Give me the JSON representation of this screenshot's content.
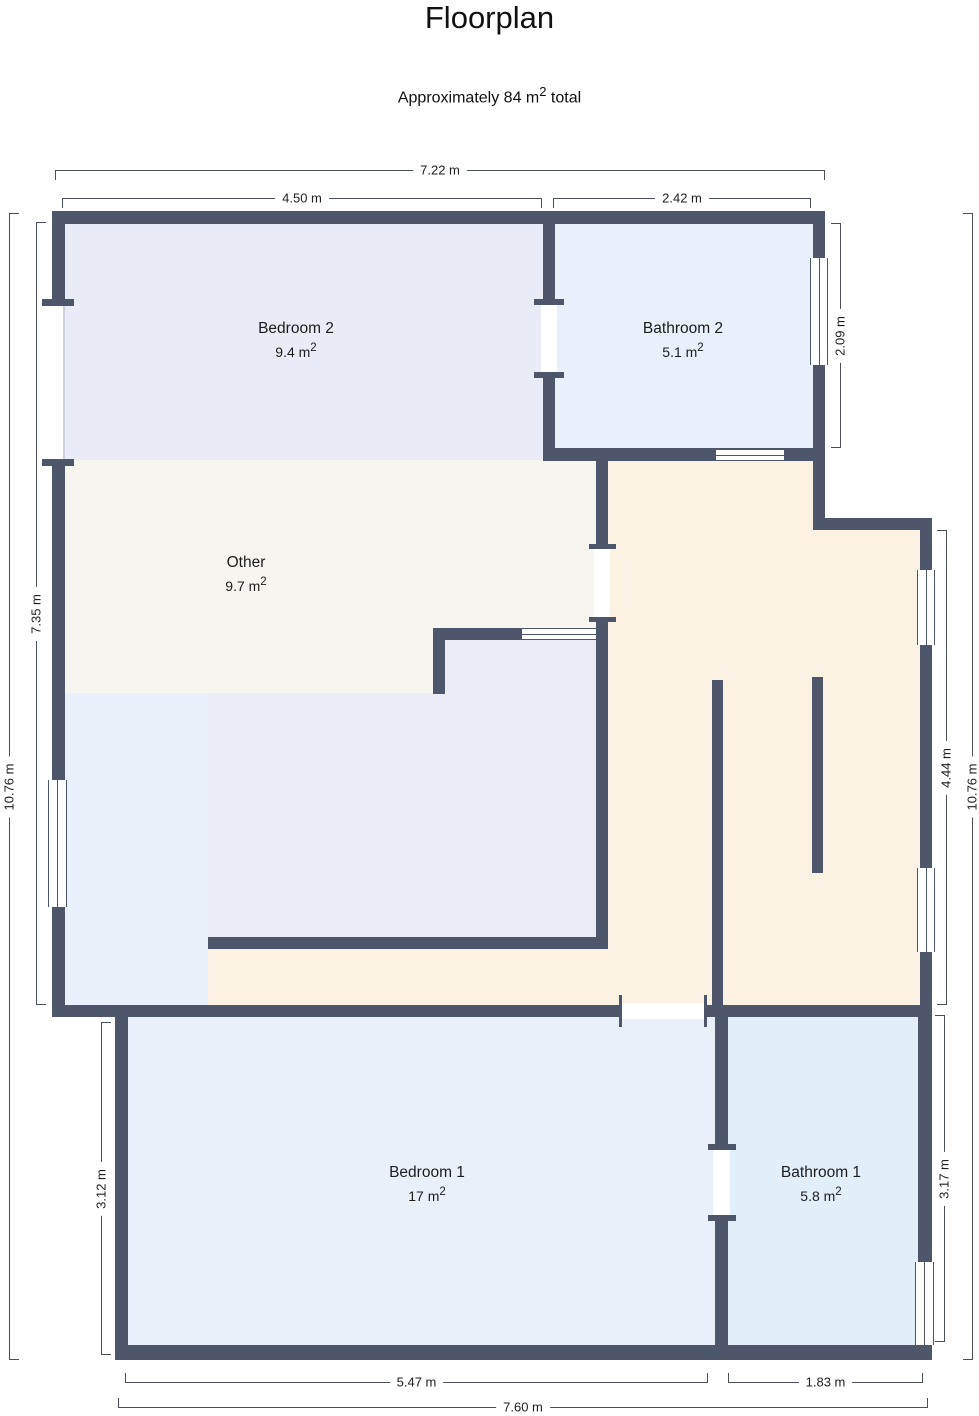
{
  "title": "Floorplan",
  "subtitle": {
    "prefix": "Approximately 84 m",
    "sup": "2",
    "suffix": " total"
  },
  "rooms": [
    {
      "label": "Bedroom 2",
      "area": "9.4 m",
      "area_sup": "2"
    },
    {
      "label": "Bathroom 2",
      "area": "5.1 m",
      "area_sup": "2"
    },
    {
      "label": "Other",
      "area": "9.7 m",
      "area_sup": "2"
    },
    {
      "label": "Bedroom 1",
      "area": "17 m",
      "area_sup": "2"
    },
    {
      "label": "Bathroom 1",
      "area": "5.8 m",
      "area_sup": "2"
    }
  ],
  "dimensions": {
    "top_total": "7.22 m",
    "top_left": "4.50 m",
    "top_right": "2.42 m",
    "bottom_left": "5.47 m",
    "bottom_right": "1.83 m",
    "bottom_total": "7.60 m",
    "left_upper": "7.35 m",
    "left_outer": "10.76 m",
    "left_lower": "3.12 m",
    "right_upper": "2.09 m",
    "right_mid": "4.44 m",
    "right_outer": "10.76 m",
    "right_lower": "3.17 m"
  },
  "colors": {
    "wall": "#4e566b",
    "dimension_line": "#4a4f5c",
    "bedroom2_floor": "#e9ecf7",
    "bathroom2_floor": "#e7f0fb",
    "other_floor": "#f6f5f0",
    "interior_room_floor": "#ebecf5",
    "left_strip_floor": "#e9f1fb",
    "hall_floor": "#fcf2e3",
    "bedroom1_floor": "#eaf0fa",
    "bathroom1_floor": "#e3eefb"
  }
}
